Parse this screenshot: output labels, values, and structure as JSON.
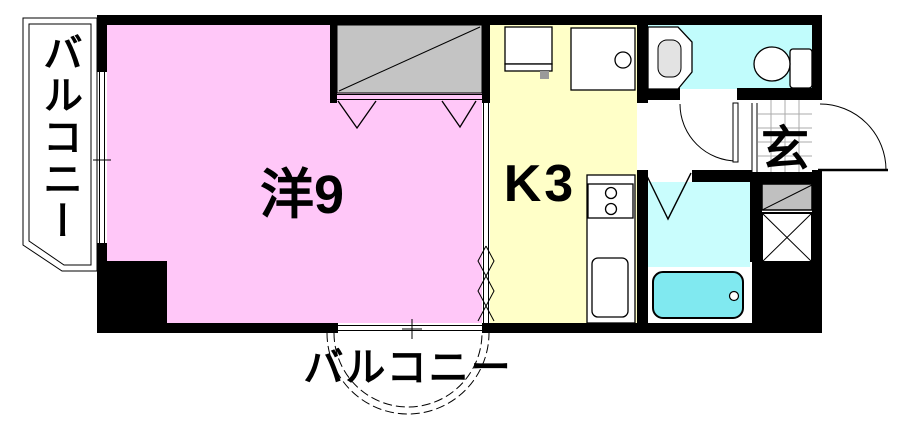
{
  "floorplan": {
    "type": "japanese-apartment-1K",
    "labels": {
      "western_room": "洋9",
      "kitchen": "K3",
      "entrance": "玄",
      "balcony_left": "バルコニー",
      "balcony_bottom": "バルコニー"
    },
    "colors": {
      "western_room": "#ffc7f8",
      "kitchen": "#ffffc8",
      "toilet_room": "#c1fcfc",
      "bathroom": "#c9fdfd",
      "bathtub": "#80e9f0",
      "closet": "#c4c4c4",
      "shoe_cabinet": "#c0c0c0",
      "basin_bowl": "#e3e3e3",
      "wall": "#000000"
    },
    "fixtures": [
      "washing-machine",
      "vanity-basin",
      "stove",
      "kitchen-sink",
      "toilet",
      "wash-basin",
      "bathtub",
      "closet",
      "shoe-cabinet",
      "pipe-shaft"
    ]
  }
}
